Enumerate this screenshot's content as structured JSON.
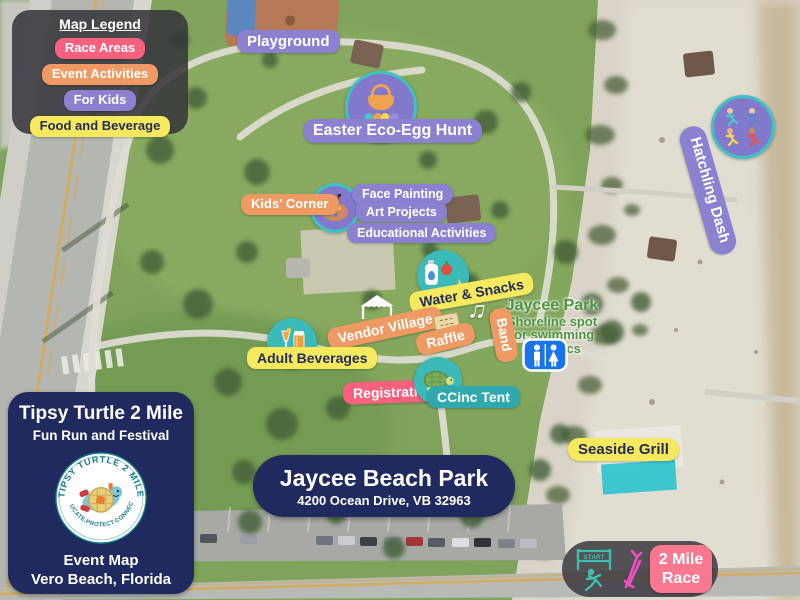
{
  "legend": {
    "title": "Map Legend",
    "items": [
      {
        "label": "Race Areas",
        "color": "#F8617E"
      },
      {
        "label": "Event Activities",
        "color": "#EE9A62"
      },
      {
        "label": "For Kids",
        "color": "#8A82D0"
      },
      {
        "label": "Food and Beverage",
        "color": "#F6E95E"
      }
    ]
  },
  "labels": {
    "playground": "Playground",
    "easter_egg_hunt": "Easter Eco-Egg Hunt",
    "kids_corner": "Kids' Corner",
    "kids_activities": [
      "Face Painting",
      "Art Projects",
      "Educational Activities"
    ],
    "water_snacks": "Water & Snacks",
    "vendor_village": "Vendor Village",
    "raffle": "Raffle",
    "band": "Band",
    "adult_beverages": "Adult Beverages",
    "registration": "Registration",
    "ccinc_tent": "CCinc Tent",
    "hatchling_dash": "Hatchling Dash",
    "seaside_grill": "Seaside Grill",
    "race_line1": "2 Mile",
    "race_line2": "Race"
  },
  "base_map": {
    "park_name": "Jaycee Park",
    "park_desc": [
      "Shoreline spot",
      "for swimming",
      "& picnics"
    ]
  },
  "race_start": {
    "label": "START"
  },
  "icons": {
    "music_note": "♫"
  },
  "info_card": {
    "title": "Tipsy Turtle 2 Mile",
    "subtitle": "Fun Run and Festival",
    "logo_arc_top": "TIPSY TURTLE 2 MILE",
    "logo_arc_bottom": "EDUCATE.PROTECT.CONNECT.",
    "footer_line1": "Event Map",
    "footer_line2": "Vero Beach, Florida"
  },
  "location_card": {
    "title": "Jaycee Beach Park",
    "address": "4200 Ocean Drive, VB 32963"
  },
  "colors": {
    "race_areas_pink": "#F8617E",
    "event_activities_orange": "#EE9A62",
    "for_kids_purple": "#8A82D0",
    "food_beverage_yellow": "#F6E95E",
    "teal_badge": "#2FA9AE",
    "teal_icon_circle": "#3CBAB9",
    "navy_card": "#202A5E",
    "map_label_green": "#4E9441",
    "restroom_blue": "#1A73E8",
    "race_arrow_pink": "#F04FC4"
  }
}
